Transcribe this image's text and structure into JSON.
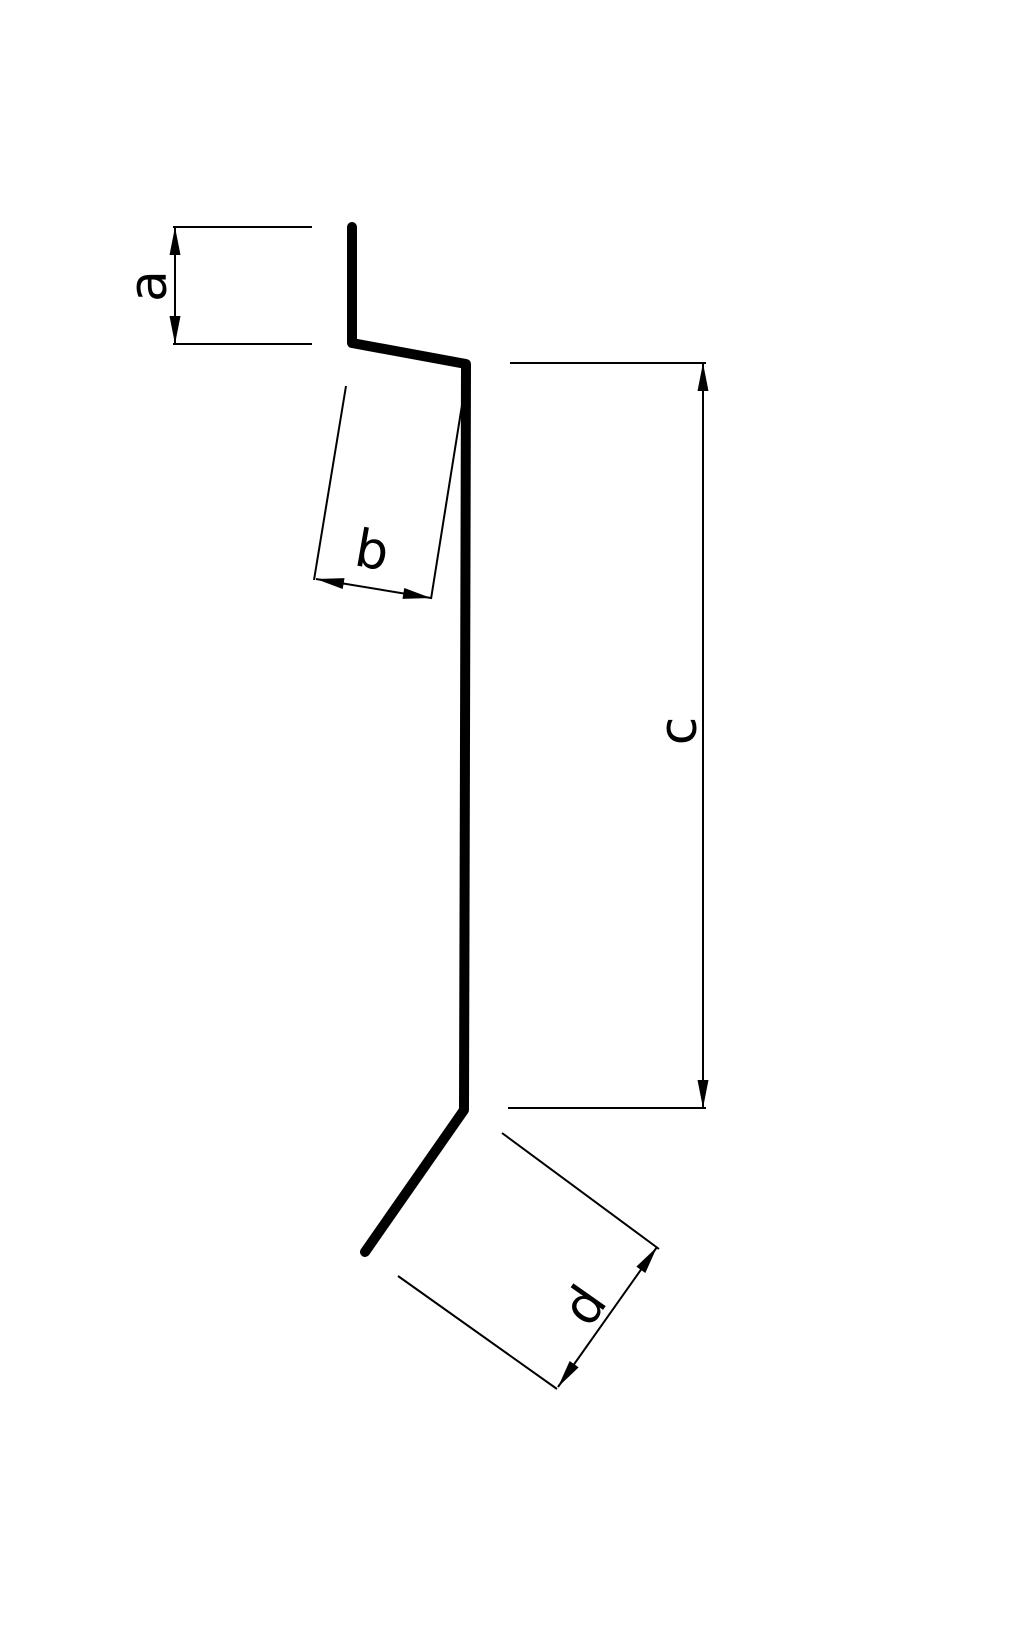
{
  "page": {
    "background_color": "#ffffff"
  },
  "diagram": {
    "type": "sheet-metal-profile-cross-section",
    "canvas": {
      "width": 1025,
      "height": 1632
    },
    "ink_color": "#000000",
    "profile": {
      "stroke_width": 10,
      "points": [
        [
          352,
          227
        ],
        [
          352,
          343
        ],
        [
          466,
          364
        ],
        [
          464,
          1110
        ],
        [
          365,
          1252
        ]
      ]
    },
    "dim_style": {
      "line_width": 2,
      "arrow_length": 28,
      "arrow_width": 11,
      "font_size": 52
    },
    "dimensions": [
      {
        "label": "a",
        "ext_lines": [
          [
            312,
            227,
            173,
            227
          ],
          [
            312,
            344,
            173,
            344
          ]
        ],
        "dim_line": [
          175,
          227,
          175,
          344
        ],
        "label_pos": [
          149,
          286
        ],
        "label_rotation": -90
      },
      {
        "label": "b",
        "ext_lines": [
          [
            346,
            386,
            314,
            580
          ],
          [
            462,
            405,
            431,
            599
          ]
        ],
        "dim_line": [
          316,
          579,
          431,
          598
        ],
        "label_pos": [
          372,
          551
        ],
        "label_rotation": 10
      },
      {
        "label": "c",
        "ext_lines": [
          [
            510,
            363,
            706,
            363
          ],
          [
            508,
            1108,
            706,
            1108
          ]
        ],
        "dim_line": [
          703,
          363,
          703,
          1108
        ],
        "label_pos": [
          679,
          731
        ],
        "label_rotation": -90
      },
      {
        "label": "d",
        "ext_lines": [
          [
            502,
            1133,
            659,
            1249
          ],
          [
            398,
            1276,
            557,
            1389
          ]
        ],
        "dim_line": [
          657,
          1247,
          558,
          1387
        ],
        "label_pos": [
          585,
          1306
        ],
        "label_rotation": -55
      }
    ]
  }
}
